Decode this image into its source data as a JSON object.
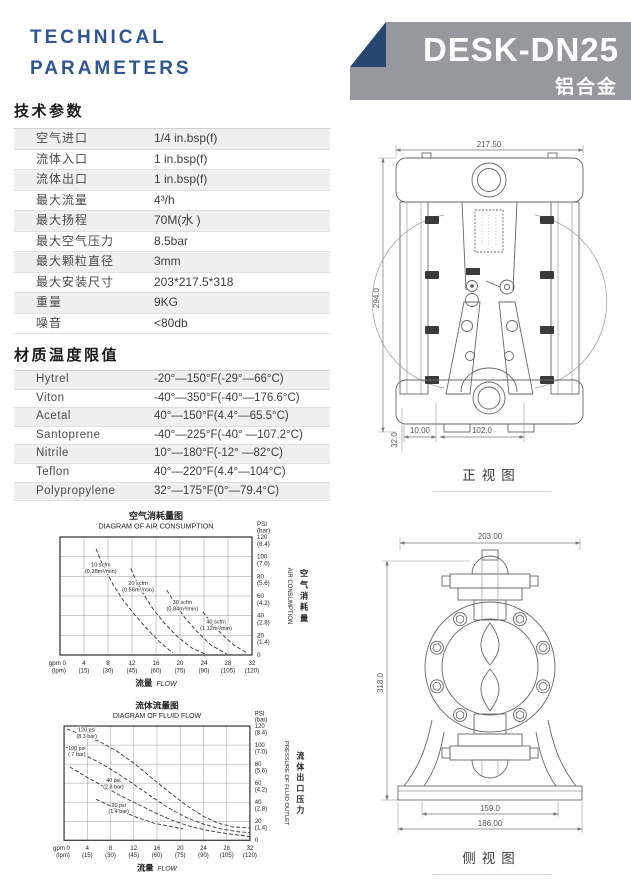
{
  "header": {
    "title_line1": "TECHNICAL",
    "title_line2": "PARAMETERS",
    "model": "DESK-DN25",
    "material": "铝合金",
    "accent_color": "#2C5694",
    "banner_color": "#97989D",
    "fold_color": "#27466F"
  },
  "specs": {
    "heading": "技术参数",
    "rows": [
      {
        "label": "空气进口",
        "value": "1/4 in.bsp(f)"
      },
      {
        "label": "流体入口",
        "value": "1 in.bsp(f)"
      },
      {
        "label": "流体出口",
        "value": "1 in.bsp(f)"
      },
      {
        "label": "最大流量",
        "value": "4³/h"
      },
      {
        "label": "最大扬程",
        "value": "70M(水 )"
      },
      {
        "label": "最大空气压力",
        "value": "8.5bar"
      },
      {
        "label": "最大颗粒直径",
        "value": "3mm"
      },
      {
        "label": "最大安装尺寸",
        "value": "203*217.5*318"
      },
      {
        "label": "重量",
        "value": "9KG"
      },
      {
        "label": "噪音",
        "value": "<80db"
      }
    ]
  },
  "materials": {
    "heading": "材质温度限值",
    "rows": [
      {
        "label": "Hytrel",
        "value": "-20°—150°F(-29°—66°C)"
      },
      {
        "label": "Viton",
        "value": "-40°—350°F(-40°—176.6°C)"
      },
      {
        "label": "Acetal",
        "value": "40°—150°F(4.4°—65.5°C)"
      },
      {
        "label": "Santoprene",
        "value": "-40°—225°F(-40° —107.2°C)"
      },
      {
        "label": "Nitrile",
        "value": "10°—180°F(-12° —82°C)"
      },
      {
        "label": "Teflon",
        "value": "40°—220°F(4.4°—104°C)"
      },
      {
        "label": "Polypropylene",
        "value": "32°—175°F(0°—79.4°C)"
      }
    ]
  },
  "chart_data": [
    {
      "type": "line",
      "title_zh": "空气消耗量图",
      "title_en": "DIAGRAM OF AIR CONSUMPTION",
      "xlabel_zh": "流量",
      "xlabel_en": "FLOW",
      "x_unit_primary": "gpm",
      "x_unit_secondary": "(lpm)",
      "y_unit_primary": "PSI",
      "y_unit_secondary": "(bar)",
      "ylabel_en": "AIR CONSUMPTION",
      "ylabel_zh": "空气消耗量",
      "xlim": [
        0,
        32
      ],
      "ylim": [
        0,
        120
      ],
      "grid": true,
      "x_ticks_gpm": [
        "0",
        "4",
        "8",
        "12",
        "16",
        "20",
        "24",
        "28",
        "32"
      ],
      "x_ticks_lpm": [
        "",
        "(15)",
        "(30)",
        "(45)",
        "(60)",
        "(75)",
        "(90)",
        "(105)",
        "(120)"
      ],
      "y_ticks_psi": [
        "120",
        "100",
        "80",
        "60",
        "40",
        "20",
        "0"
      ],
      "y_ticks_bar": [
        "(8.4)",
        "(7.0)",
        "(5.6)",
        "(4.2)",
        "(2.8)",
        "(1.4)",
        ""
      ],
      "series": [
        {
          "name": "10 scfm (0.28m³/min)",
          "label": [
            "10 scfm",
            "(0.28m³/min)"
          ],
          "label_at": [
            6.8,
            88
          ],
          "points": [
            [
              6,
              108
            ],
            [
              6.8,
              96
            ],
            [
              7.8,
              84
            ],
            [
              9,
              70
            ],
            [
              10.5,
              56
            ],
            [
              12.3,
              42
            ],
            [
              14.3,
              28
            ],
            [
              16.5,
              14
            ],
            [
              18.8,
              2
            ]
          ]
        },
        {
          "name": "20 scfm (0.56m³/min)",
          "label": [
            "20 scfm",
            "(0.56m³/min)"
          ],
          "label_at": [
            13,
            69
          ],
          "points": [
            [
              11.8,
              88
            ],
            [
              12.8,
              74
            ],
            [
              14,
              61
            ],
            [
              15.5,
              47
            ],
            [
              17.3,
              33
            ],
            [
              19.5,
              19
            ],
            [
              22,
              7
            ],
            [
              24.2,
              1
            ]
          ]
        },
        {
          "name": "30 scfm (0.84m³/min)",
          "label": [
            "30 scfm",
            "(0.84m³/min)"
          ],
          "label_at": [
            20.4,
            50
          ],
          "points": [
            [
              17.8,
              66
            ],
            [
              19.2,
              52
            ],
            [
              20.8,
              38
            ],
            [
              22.8,
              24
            ],
            [
              25.2,
              10
            ],
            [
              27.8,
              1
            ]
          ]
        },
        {
          "name": "40 scfm (1.12m³/min)",
          "label": [
            "40 scfm",
            "(1.12m³/min)"
          ],
          "label_at": [
            26,
            30
          ],
          "points": [
            [
              23.8,
              44
            ],
            [
              25.3,
              32
            ],
            [
              27,
              21
            ],
            [
              29,
              10
            ],
            [
              31.2,
              2
            ]
          ]
        }
      ]
    },
    {
      "type": "line",
      "title_zh": "流体流量图",
      "title_en": "DIAGRAM OF FLUID FLOW",
      "xlabel_zh": "流量",
      "xlabel_en": "FLOW",
      "x_unit_primary": "gpm",
      "x_unit_secondary": "(lpm)",
      "y_unit_primary": "PSI",
      "y_unit_secondary": "(bar)",
      "ylabel_en": "PRESSURE OF FLUID OUTLET",
      "ylabel_zh": "流体出口压力",
      "xlim": [
        0,
        32
      ],
      "ylim": [
        0,
        120
      ],
      "grid": true,
      "x_ticks_gpm": [
        "0",
        "4",
        "8",
        "12",
        "16",
        "20",
        "24",
        "28",
        "32"
      ],
      "x_ticks_lpm": [
        "",
        "(15)",
        "(30)",
        "(45)",
        "(60)",
        "(75)",
        "(90)",
        "(105)",
        "(120)"
      ],
      "y_ticks_psi": [
        "120",
        "100",
        "80",
        "60",
        "40",
        "20",
        "0"
      ],
      "y_ticks_bar": [
        "(8.4)",
        "(7.0)",
        "(5.6)",
        "(4.2)",
        "(2.8)",
        "(1.4)",
        ""
      ],
      "series": [
        {
          "name": "120 psi (8.3 bar)",
          "label": [
            "120 psi",
            "(8.3 bar)"
          ],
          "label_at": [
            3.9,
            112
          ],
          "points": [
            [
              0.5,
              117
            ],
            [
              3,
              111
            ],
            [
              6,
              104
            ],
            [
              9,
              94
            ],
            [
              12,
              81
            ],
            [
              15,
              66
            ],
            [
              18,
              51
            ],
            [
              21,
              37
            ],
            [
              24,
              25
            ],
            [
              26.5,
              18
            ],
            [
              29,
              14
            ],
            [
              32,
              13
            ]
          ]
        },
        {
          "name": "100 psi (7 bar)",
          "label": [
            "100 psi",
            "( 7 bar)"
          ],
          "label_at": [
            2.2,
            93
          ],
          "points": [
            [
              0.3,
              98
            ],
            [
              3,
              91
            ],
            [
              6,
              82
            ],
            [
              9,
              71
            ],
            [
              12,
              59
            ],
            [
              15,
              46
            ],
            [
              18,
              34
            ],
            [
              21,
              24
            ],
            [
              24,
              17
            ],
            [
              27,
              12
            ],
            [
              30,
              9
            ],
            [
              32,
              8
            ]
          ]
        },
        {
          "name": "40 psi (2.8 bar)",
          "label": [
            "40 psi",
            "(2.8 bar)"
          ],
          "label_at": [
            8.5,
            59
          ],
          "points": [
            [
              1,
              77
            ],
            [
              4,
              66
            ],
            [
              7,
              56
            ],
            [
              10,
              46
            ],
            [
              13,
              37
            ],
            [
              16,
              28
            ],
            [
              19,
              20
            ],
            [
              22,
              14
            ],
            [
              25,
              10
            ],
            [
              28,
              7
            ],
            [
              32,
              4
            ]
          ]
        },
        {
          "name": "20 psi (1.4 bar)",
          "label": [
            "20 psi",
            "(1.4 bar)"
          ],
          "label_at": [
            9.4,
            33
          ],
          "points": [
            [
              5.5,
              43
            ],
            [
              8,
              36
            ],
            [
              10.5,
              29
            ],
            [
              13,
              23
            ],
            [
              15.5,
              18
            ],
            [
              18,
              15
            ],
            [
              20.5,
              12
            ]
          ]
        }
      ]
    }
  ],
  "drawings": {
    "front": {
      "caption": "正视图",
      "dim_width": "217.50",
      "dim_height": "294.0",
      "dim_base_height": "32.0",
      "dim_offset": "10.00",
      "dim_port_span": "102.0"
    },
    "side": {
      "caption": "侧视图",
      "dim_width": "203.00",
      "dim_height": "318.0",
      "dim_inner_base": "159.0",
      "dim_outer_base": "186.00"
    }
  }
}
